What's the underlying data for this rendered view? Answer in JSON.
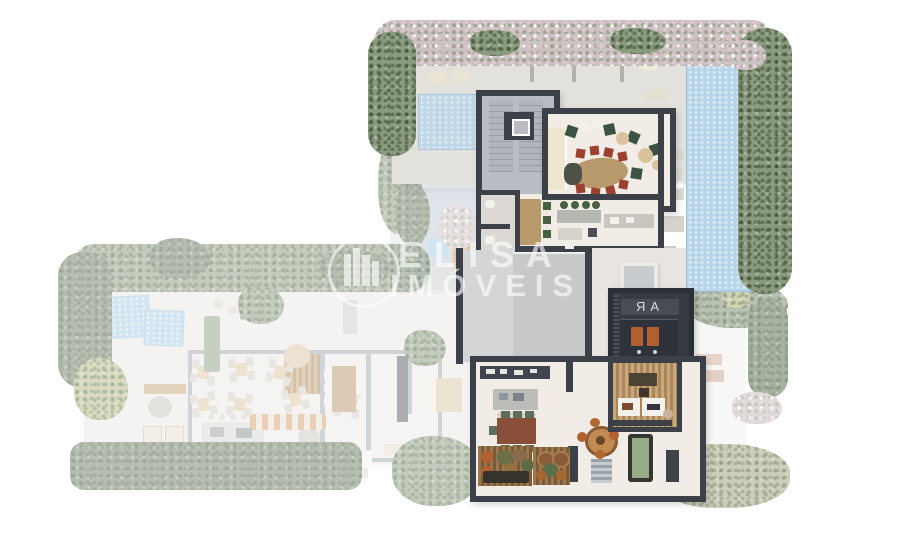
{
  "watermark": {
    "brand_line1": "ELISA",
    "brand_line2": "IMÓVEIS",
    "logo": "buildings-in-circle-icon"
  },
  "sauna": {
    "glass_glyph": "ЯA"
  },
  "palette": {
    "wall": "#3c4049",
    "wall_light": "#a3aab3",
    "floor": "#f1ede6",
    "floor_gray": "#e3e1dc",
    "roof": "#c7c9cb",
    "pool": "#b7d5e9",
    "pool_edge": "#9cc0d9",
    "hedge": "#8a9a7e",
    "hedge_dark": "#6d7f63",
    "hedge_yellow": "#b4b87f",
    "flower": "#cbc2c2",
    "wood": "#b8996b",
    "wood_dark": "#8a5c3a",
    "deck_a": "#c9a87d",
    "deck_b": "#ab8659",
    "deck_dk_a": "#9a774f",
    "deck_dk_b": "#7c5a38",
    "red_chair": "#9c402f",
    "green_seat": "#48603f",
    "green_dark": "#3c5244",
    "sauna": "#363a42",
    "sauna_deep": "#2b2f36",
    "orange": "#b2602f",
    "billiard": "#97ab88",
    "cream": "#efe6d0",
    "blue_tile": "#a9cde2"
  }
}
